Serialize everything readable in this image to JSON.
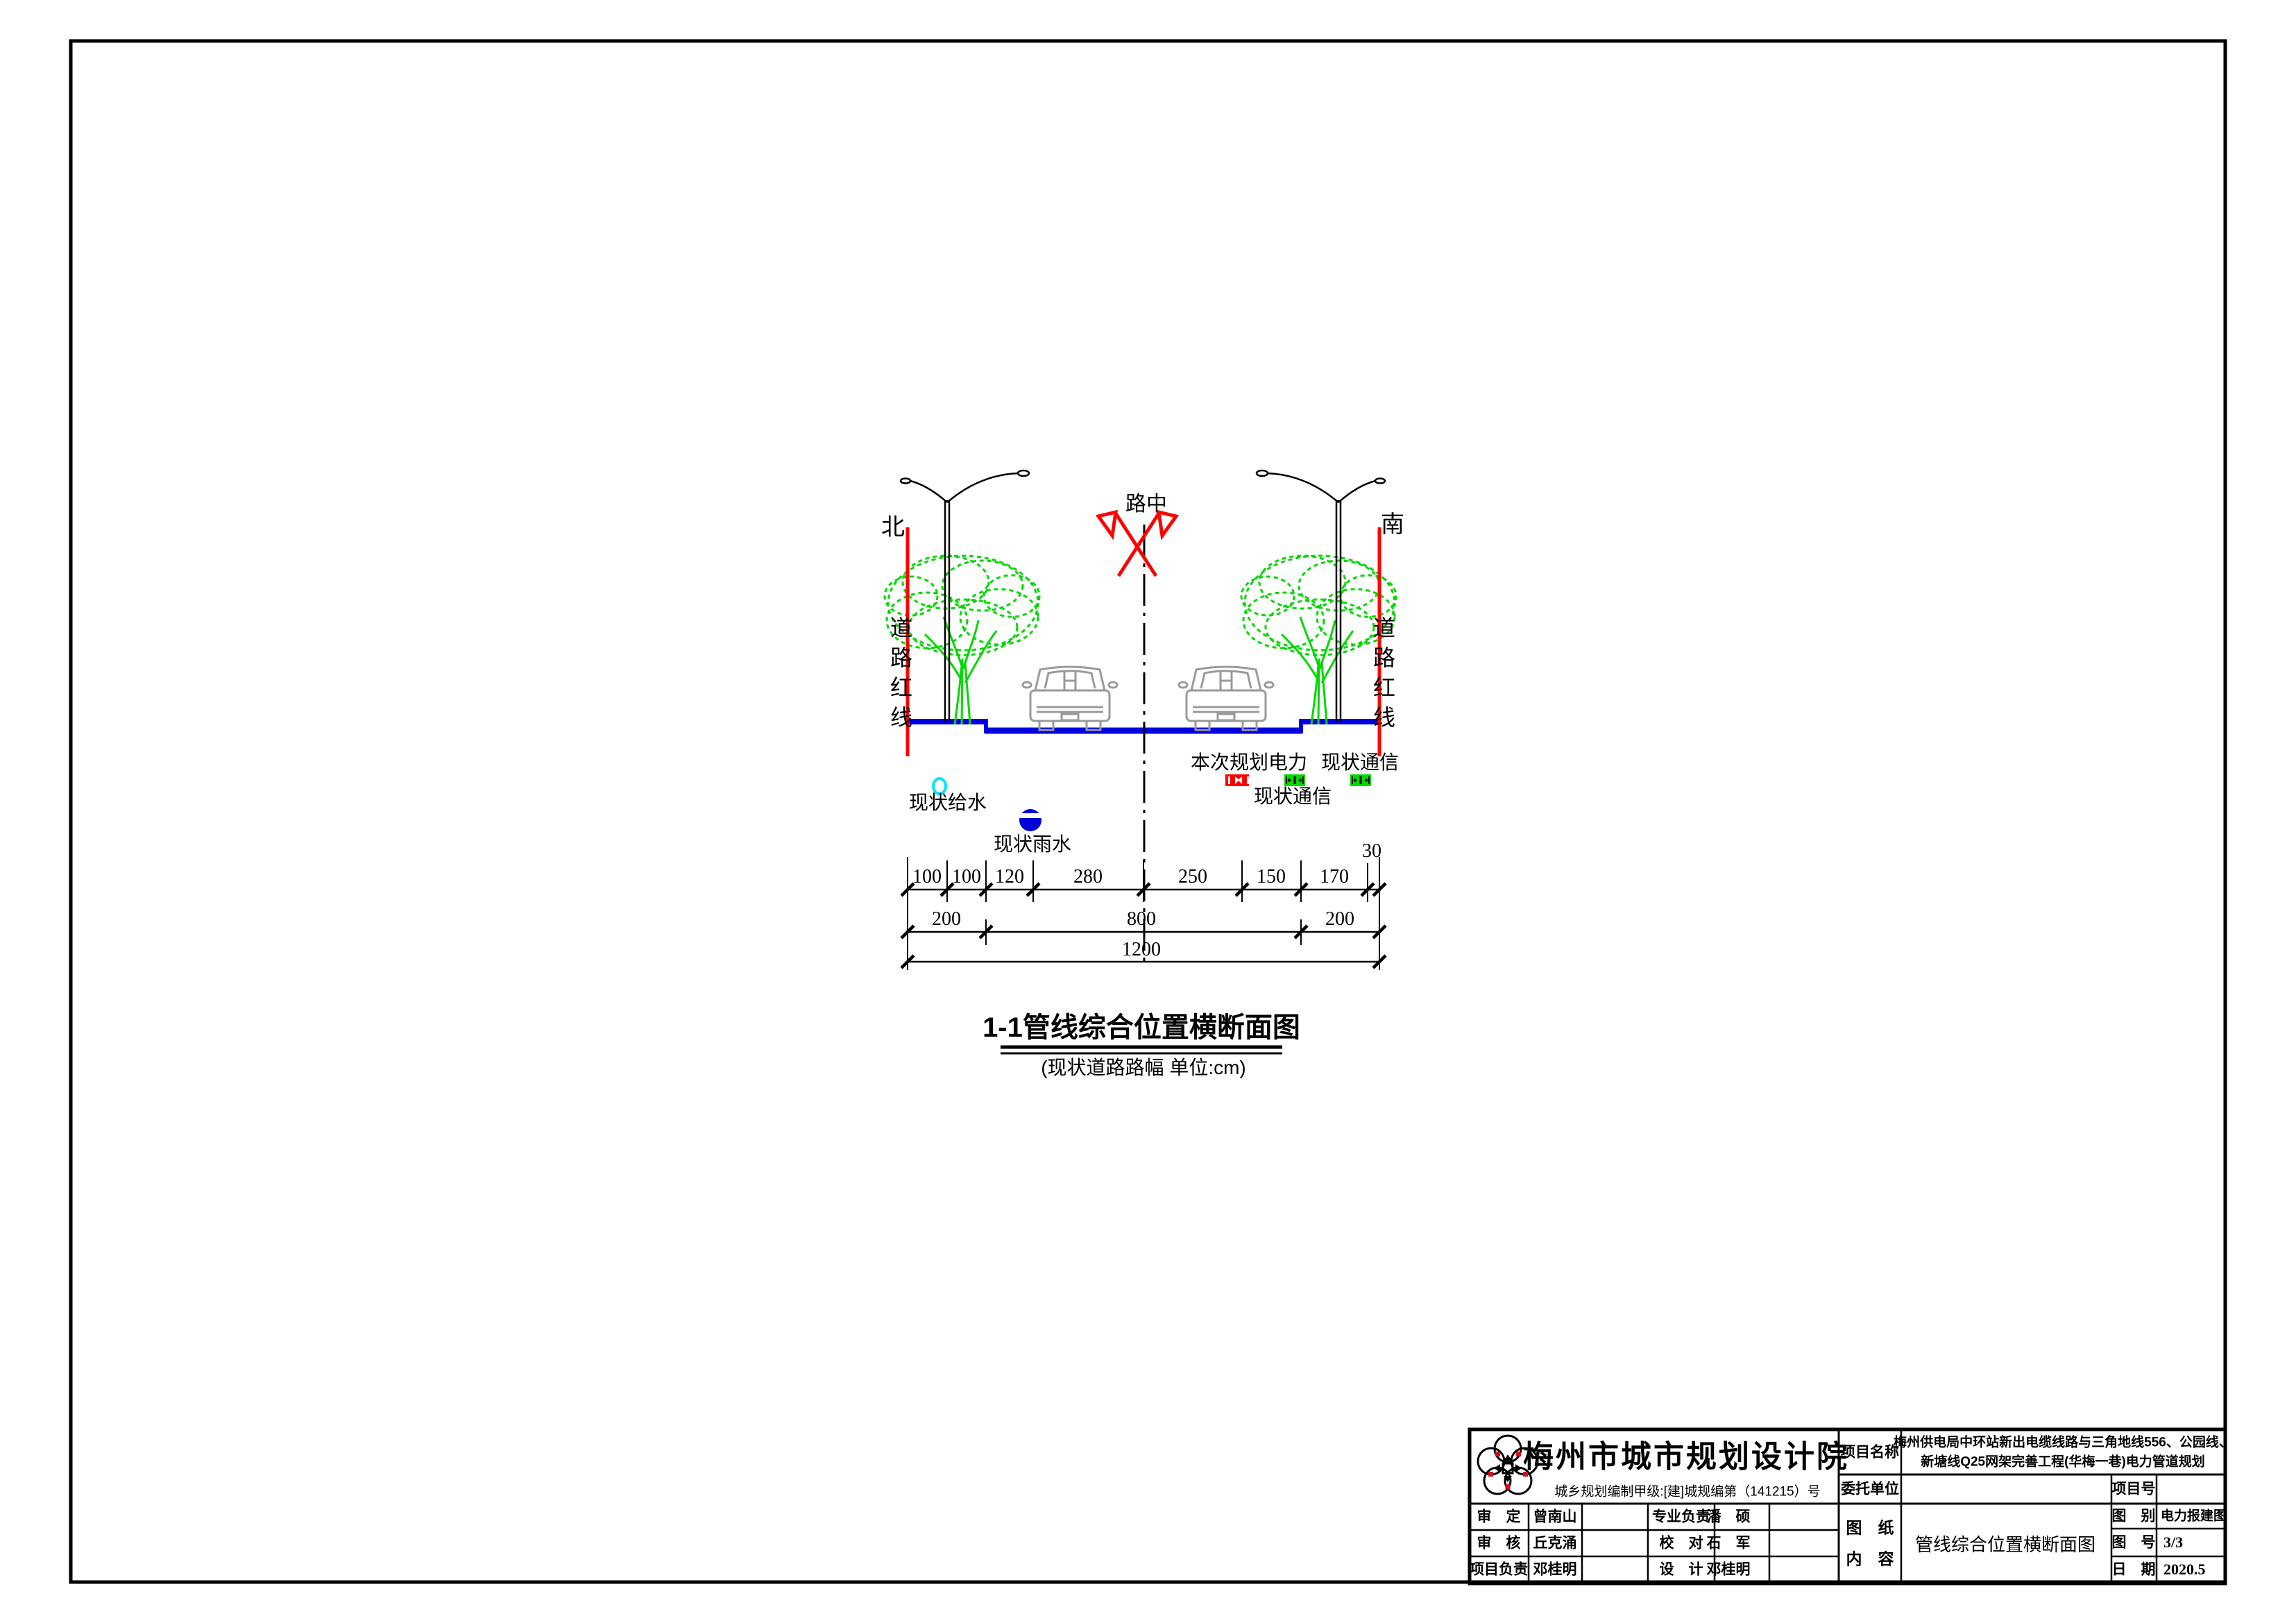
{
  "drawing": {
    "north_label": "北",
    "south_label": "南",
    "redline_label_left": "道路红线",
    "redline_label_right": "道路红线",
    "center_label": "路中",
    "legend": {
      "planned_power": "本次规划电力",
      "existing_comm_upper": "现状通信",
      "existing_comm_lower": "现状通信",
      "existing_water": "现状给水",
      "existing_storm": "现状雨水"
    },
    "dims": {
      "row1": [
        "100",
        "100",
        "120",
        "280",
        "250",
        "150",
        "170"
      ],
      "offset": "30",
      "row2": [
        "200",
        "800",
        "200"
      ],
      "total": "1200"
    },
    "title": "1-1管线综合位置横断面图",
    "subtitle": "(现状道路路幅 单位:cm)"
  },
  "title_block": {
    "company": "梅州市城市规划设计院",
    "license": "城乡规划编制甲级:[建]城规编第（141215）号",
    "staff": {
      "r1c1": "审　定",
      "r1c2": "曾南山",
      "r1c3": "专业负责",
      "r1c4": "潘　硕",
      "r2c1": "审　核",
      "r2c2": "丘克涌",
      "r2c3": "校　对",
      "r2c4": "石　军",
      "r3c1": "项目负责",
      "r3c2": "邓桂明",
      "r3c3": "设　计",
      "r3c4": "邓桂明"
    },
    "project_name_label": "项目名称",
    "project_name_line1": "梅州供电局中环站新出电缆线路与三角地线556、公园线、",
    "project_name_line2": "新塘线Q25网架完善工程(华梅一巷)电力管道规划",
    "client_label": "委托单位",
    "project_no_label": "项目号",
    "sheet_content_label_1": "图　纸",
    "sheet_content_label_2": "内　容",
    "sheet_content": "管线综合位置横断面图",
    "category_label": "图　别",
    "category_value": "电力报建图",
    "sheet_no_label": "图　号",
    "sheet_no_value": "3/3",
    "date_label": "日　期",
    "date_value": "2020.5"
  },
  "colors": {
    "redline": "#ff0000",
    "tree": "#00d800",
    "road": "#0000e0",
    "water": "#00e5ff",
    "storm": "#0000d8",
    "power_box": "#ff0000",
    "comm_box": "#00d800",
    "car": "#9a9a9a"
  }
}
